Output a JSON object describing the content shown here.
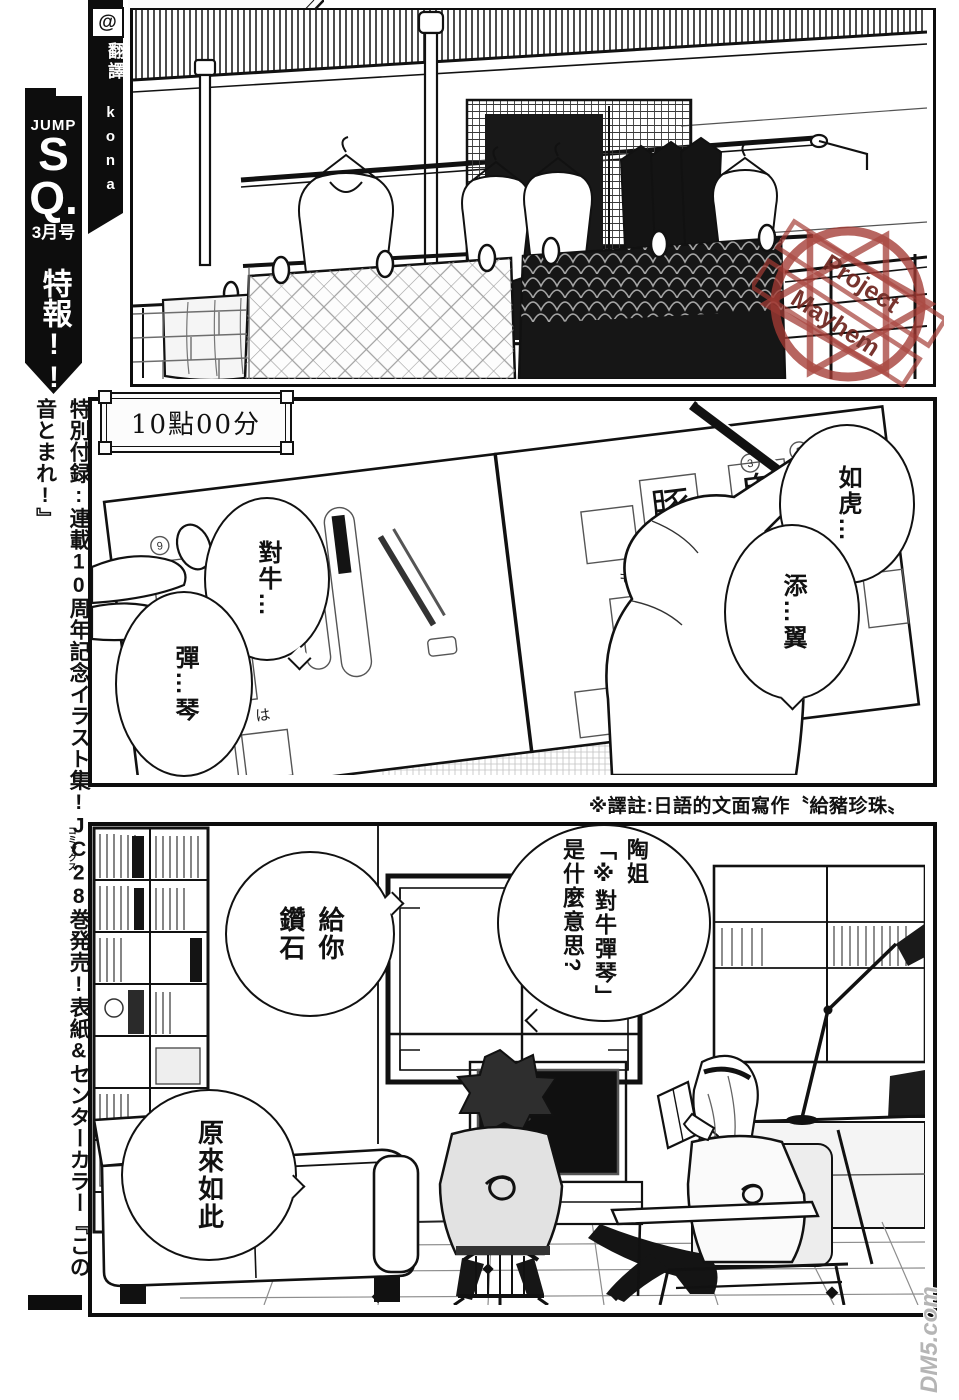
{
  "header": {
    "scanlation_group": "混成连合会"
  },
  "credit": {
    "at": "@",
    "role": "翻譯",
    "translator": "kona"
  },
  "sidebar": {
    "magazine_word": "JUMP",
    "magazine_s": "S",
    "magazine_q": "Q.",
    "issue": "3月号",
    "flash": "特報!!",
    "announcement": "特別付録:連載10周年記念イラスト集!JC28巻発売!表紙&センターカラー『この音とまれ!』",
    "comics_furigana": "コミックス"
  },
  "panel1": {
    "stamp": {
      "line1": "Project",
      "line2": "Mayhem"
    }
  },
  "panel2": {
    "caption": "10點00分",
    "bubble_ruhu": "如虎…",
    "bubble_tianyi": "添…翼",
    "bubble_duiniu": "對牛…",
    "bubble_tanqin": "彈…琴",
    "workbook": {
      "kanji": [
        "豚",
        "鬼",
        "首"
      ],
      "kana": [
        "の",
        "は",
        "も",
        "から",
        "に"
      ],
      "numbers": [
        "9",
        "3",
        "2",
        "1"
      ]
    }
  },
  "note": "※譯註:日語的文面寫作〝給豬珍珠〟",
  "panel3": {
    "bubble_diamond": "給你\n鑽石",
    "bubble_question": "陶姐\n「※對牛彈琴」\n是什麼意思?",
    "bubble_isee": "原來如此"
  },
  "watermark": "DM5.com"
}
